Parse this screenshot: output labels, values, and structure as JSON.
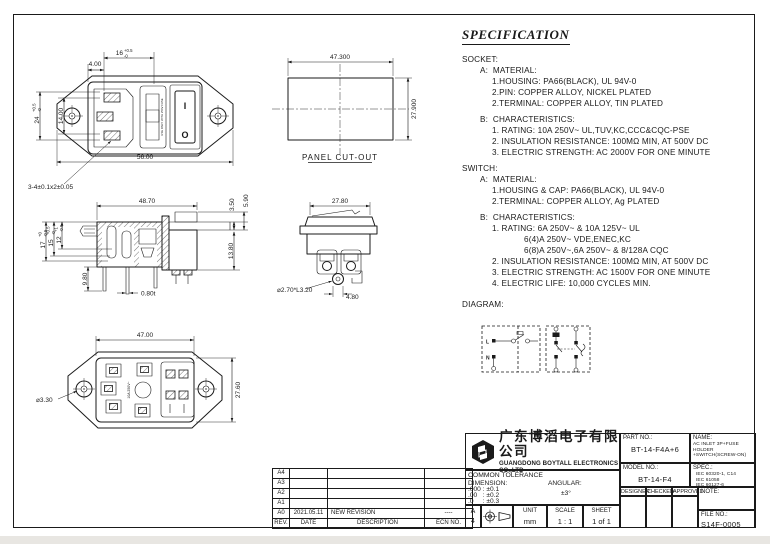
{
  "page": {
    "line_color": "#1a1a1a",
    "paper_color": "#ffffff",
    "edge_strip_color": "#e8e6e2"
  },
  "spec": {
    "title": "SPECIFICATION",
    "lines": [
      "SOCKET:",
      "A:  MATERIAL:",
      "1.HOUSING: PA66(BLACK), UL 94V-0",
      "2.PIN: COPPER ALLOY, NICKEL PLATED",
      "2.TERMINAL: COPPER ALLOY, TIN PLATED",
      "B:  CHARACTERISTICS:",
      "1. RATING: 10A 250V~ UL,TUV,KC,CCC&CQC-PSE",
      "2. INSULATION RESISTANCE: 100MΩ MIN, AT 500V DC",
      "3. ELECTRIC STRENGTH: AC 2000V FOR ONE MINUTE",
      "SWITCH:",
      "A:  MATERIAL:",
      "1.HOUSING & CAP: PA66(BLACK), UL 94V-0",
      "2.TERMINAL: COPPER ALLOY, Ag PLATED",
      "B:  CHARACTERISTICS:",
      "1. RATING: 6A 250V~ & 10A 125V~ UL",
      "6(4)A 250V~ VDE,ENEC,KC",
      "6(8)A 250V~,6A 250V~ & 8/128A CQC",
      "2. INSULATION RESISTANCE: 100MΩ MIN, AT 500V DC",
      "3. ELECTRIC STRENGTH: AC 1500V FOR ONE MINUTE",
      "4. ELECTRIC LIFE: 10,000 CYCLES MIN.",
      "DIAGRAM:"
    ]
  },
  "views": {
    "front": {
      "dim_a": "4.00",
      "dim_b_v": "16",
      "dim_b_up": "+0.5",
      "dim_b_dn": "-0",
      "dim_c_v": "24",
      "dim_c_up": "+0.5",
      "dim_c_dn": "-0",
      "dim_d": "14.00",
      "dim_e": "56.00",
      "pin_note": "3-4±0.1x2±0.05",
      "fuse_text": "USE ONLY WITH 250V FUSE",
      "mark_on": "I",
      "mark_off": "O"
    },
    "cutout": {
      "dim_w": "47.300",
      "dim_h": "27.900",
      "label": "PANEL CUT-OUT"
    },
    "side": {
      "dim_w": "48.70",
      "dim_a": "3.50",
      "dim_b": "5.90",
      "dim_c": "13.80",
      "d17_v": "17",
      "d17_up": "+0",
      "d17_dn": "-0.5",
      "d15_v": "15",
      "d15_up": "+0.5",
      "d15_dn": "-0",
      "d12_v": "12",
      "d12_up": "+1",
      "d12_dn": "-0.5",
      "dim_d": "9.80",
      "dim_t": "0.80t"
    },
    "end": {
      "dim_w": "27.80",
      "hole_note": "⌀2.70*L3.20",
      "dim_p": "4.80"
    },
    "bottom": {
      "dim_w": "47.00",
      "dim_h": "27.60",
      "hole_note": "⌀3.30",
      "rating_text": "10A 250V~"
    }
  },
  "diagram": {
    "l": "L",
    "n": "N"
  },
  "revisions": {
    "rows": [
      {
        "rev": "A4",
        "date": "",
        "desc": "",
        "ecn": ""
      },
      {
        "rev": "A3",
        "date": "",
        "desc": "",
        "ecn": ""
      },
      {
        "rev": "A2",
        "date": "",
        "desc": "",
        "ecn": ""
      },
      {
        "rev": "A1",
        "date": "",
        "desc": "",
        "ecn": ""
      },
      {
        "rev": "A0",
        "date": "2021.05.11",
        "desc": "NEW REVISION",
        "ecn": "----"
      }
    ],
    "header": {
      "rev": "REV.",
      "date": "DATE",
      "desc": "DESCRIPTION",
      "ecn": "ECN NO."
    }
  },
  "titleblock": {
    "company_cn": "广东博滔电子有限公司",
    "company_en": "GUANGDONG BOYTALL ELECTRONICS CO.,LTD",
    "part_label": "PART NO.:",
    "part_value": "BT-14-F4A+6",
    "name_label": "NAME:",
    "name_line1": "AC INLET 3P+FUSE HOLDER",
    "name_line2": "+SWITCH(SCREW-ON)",
    "model_label": "MODEL NO.:",
    "model_value": "BT-14-F4",
    "spec_label": "SPEC.:",
    "spec_line1": "IEC 60320-1, C14",
    "spec_line2": "IEC 61058",
    "spec_line3": "IEC 60127-6",
    "designer": "DESIGNER",
    "checked": "CHECKED",
    "approved": "APPROVED",
    "note_label": "NOTE:",
    "file_label": "FILE NO.:",
    "file_value": "S14F-0005",
    "tol_title": "COMMON TOLERANCE",
    "tol_dim": "DIMENSION:",
    "tol_ang": "ANGULAR:",
    "tol_r1": ".000 : ±0.1",
    "tol_r2": ".00   : ±0.2",
    "tol_r3": ".0     : ±0.3",
    "tol_ang_v": "±3°",
    "size_l1": "A",
    "size_l2": "4",
    "unit_label": "UNIT",
    "unit_value": "mm",
    "scale_label": "SCALE",
    "scale_value": "1 : 1",
    "sheet_label": "SHEET",
    "sheet_value": "1 of 1"
  }
}
